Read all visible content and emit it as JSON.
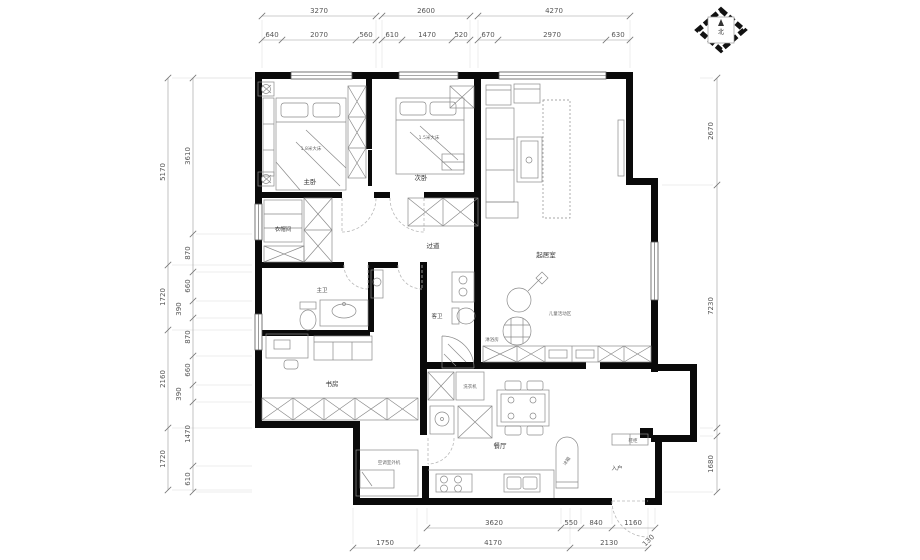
{
  "compass": {
    "north_label": "北"
  },
  "dims": {
    "top_overall": [
      "3270",
      "2600",
      "4270"
    ],
    "top_detail": [
      "640",
      "2070",
      "560",
      "610",
      "1470",
      "520",
      "670",
      "2970",
      "630"
    ],
    "left_outer": [
      "5170",
      "1720",
      "2160",
      "1720"
    ],
    "left_inner": [
      "3610",
      "870",
      "660",
      "390",
      "870",
      "660",
      "390",
      "1470",
      "610"
    ],
    "right_side": [
      "2670",
      "7230",
      "1680"
    ],
    "bottom_detail": [
      "3620",
      "550",
      "840",
      "1160",
      "130"
    ],
    "bottom_overall": [
      "1750",
      "4170",
      "2130"
    ]
  },
  "rooms": {
    "master_bedroom": "主卧",
    "second_bedroom": "次卧",
    "cloakroom": "衣帽间",
    "hallway": "过道",
    "master_bath": "主卫",
    "guest_bath": "客卫",
    "shower_room": "淋浴房",
    "study": "书房",
    "family_room": "起居室",
    "kids_play_area": "儿童活动区",
    "dining_room": "餐厅",
    "entry": "入户"
  },
  "fixtures": {
    "master_bed": "1.8米大床",
    "second_bed": "1.5米大床",
    "washing_machine": "洗衣机",
    "fridge": "冰箱",
    "shoe_cabinet": "鞋柜",
    "ac_outdoor_unit": "空调室外机"
  }
}
